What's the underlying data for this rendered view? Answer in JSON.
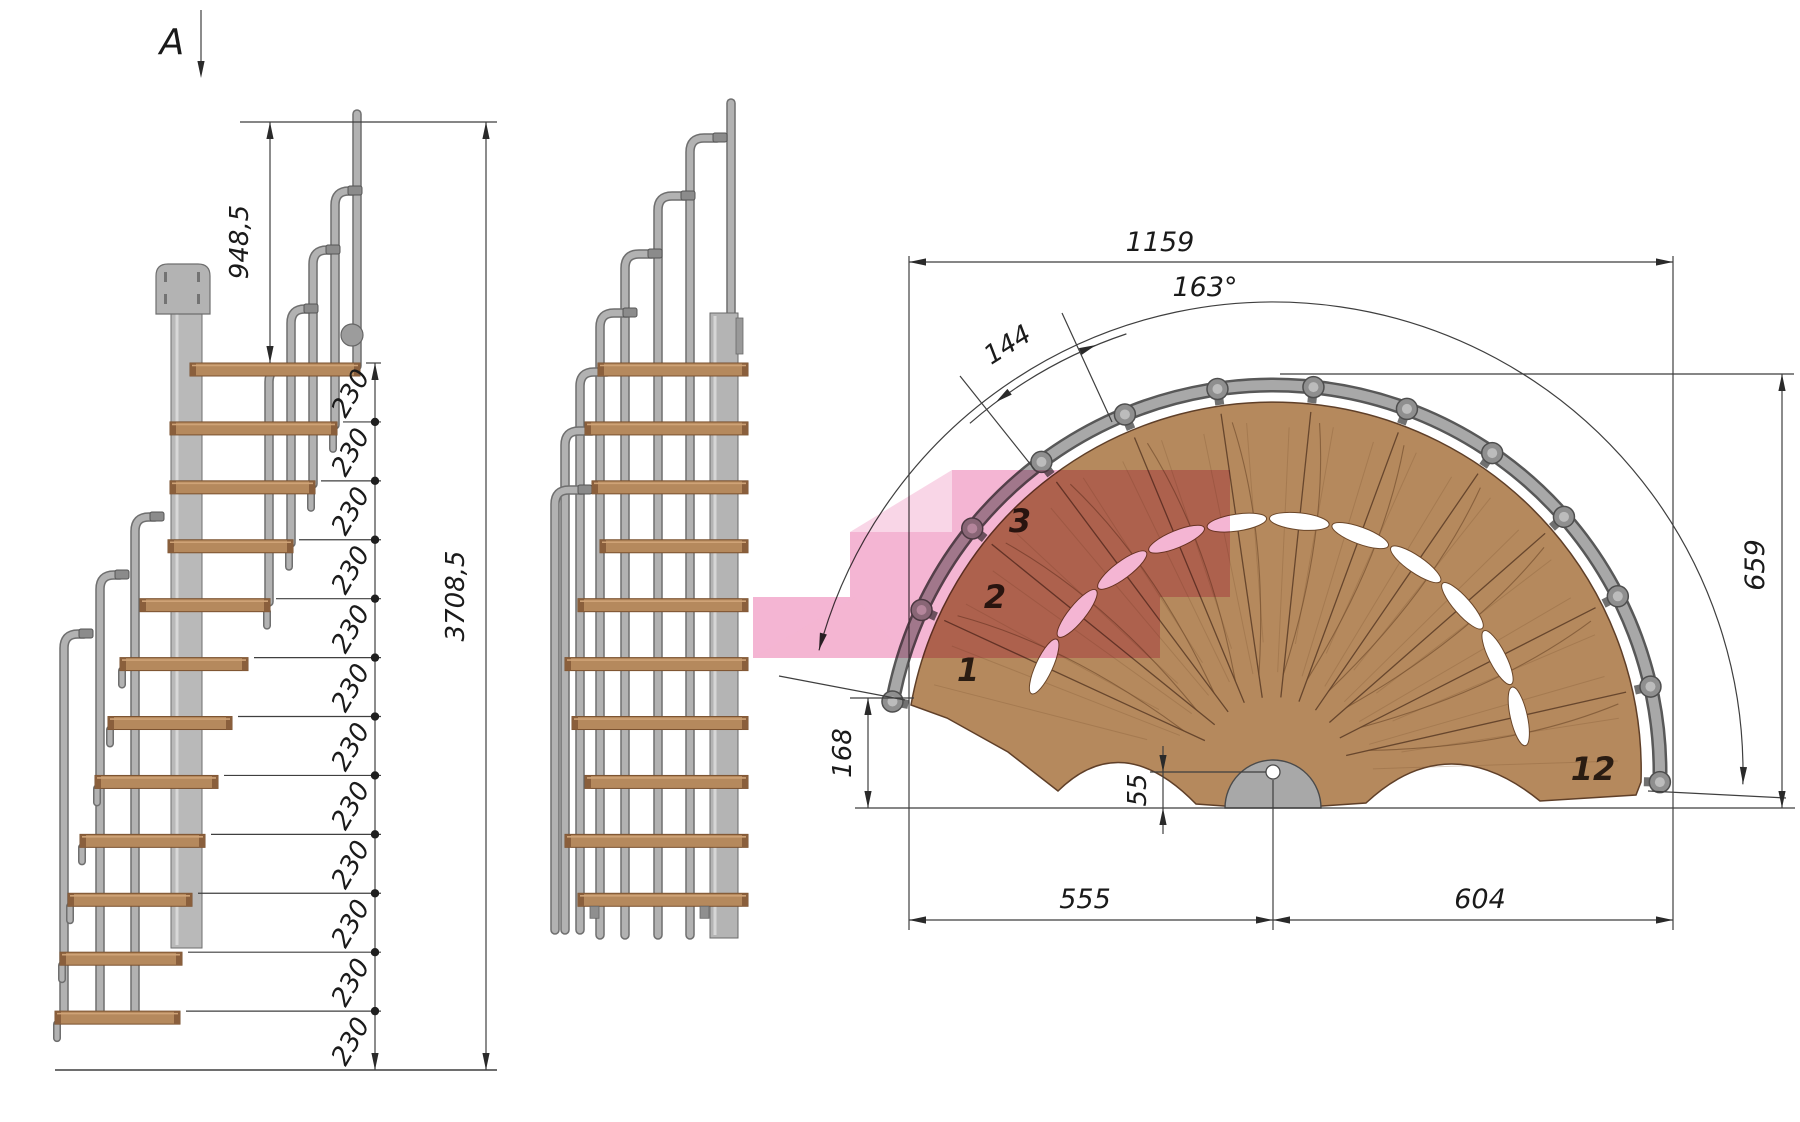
{
  "drawing_title": "Spiral staircase dimensioned drawing",
  "section_marker": {
    "label": "A"
  },
  "side_view": {
    "rail_height_label": "948,5",
    "total_height_label": "3708,5",
    "rise_labels": [
      "230",
      "230",
      "230",
      "230",
      "230",
      "230",
      "230",
      "230",
      "230",
      "230",
      "230",
      "230"
    ]
  },
  "plan_view": {
    "overall_width_label": "1159",
    "tread_width_label": "144",
    "angle_label": "163°",
    "depth_label": "659",
    "first_step_offset_label": "168",
    "pole_offset_label": "55",
    "left_span_label": "555",
    "right_span_label": "604",
    "step_numbers": {
      "first": "1",
      "second": "2",
      "third": "3",
      "last": "12"
    }
  },
  "colors": {
    "wood": "#b5895d",
    "wood_edge": "#5f3f28",
    "metal": "#b0b0b0",
    "metal_dark": "#6f6f6f",
    "dimension_line": "#3f3f3f",
    "highlight_pink": "#f2a8cb"
  }
}
